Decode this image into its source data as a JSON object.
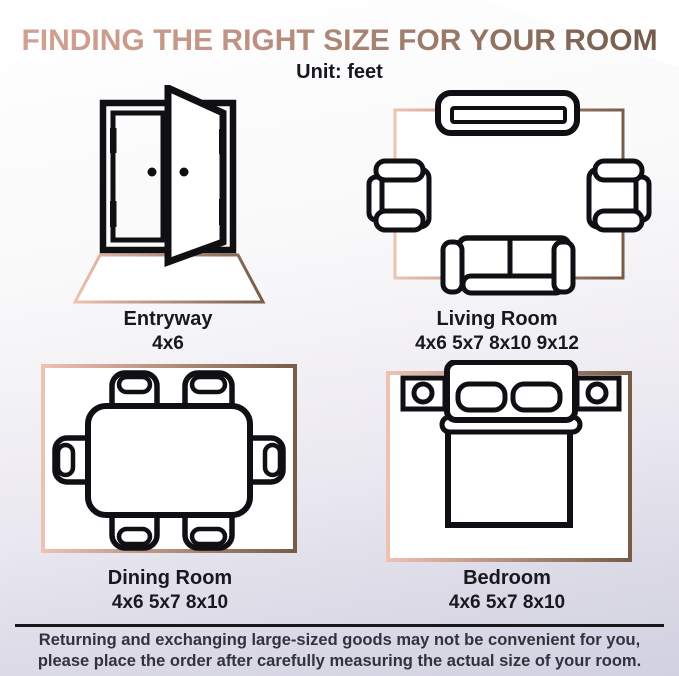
{
  "header": {
    "title": "FINDING THE RIGHT SIZE FOR YOUR ROOM",
    "subtitle": "Unit: feet"
  },
  "rooms": [
    {
      "name": "Entryway",
      "sizes": "4x6"
    },
    {
      "name": "Living Room",
      "sizes": "4x6 5x7 8x10 9x12"
    },
    {
      "name": "Dining Room",
      "sizes": "4x6 5x7 8x10"
    },
    {
      "name": "Bedroom",
      "sizes": "4x6 5x7 8x10"
    }
  ],
  "footer": {
    "line1": "Returning and exchanging large-sized goods may not be convenient for you,",
    "line2": "please place the order after carefully measuring the actual size of your room."
  },
  "colors": {
    "title_gradient_start": "#d4a294",
    "title_gradient_end": "#6f584a",
    "rug_gradient_start": "#eec1b1",
    "rug_gradient_end": "#775c48",
    "line_color": "#101014",
    "label_color": "#18181f"
  }
}
